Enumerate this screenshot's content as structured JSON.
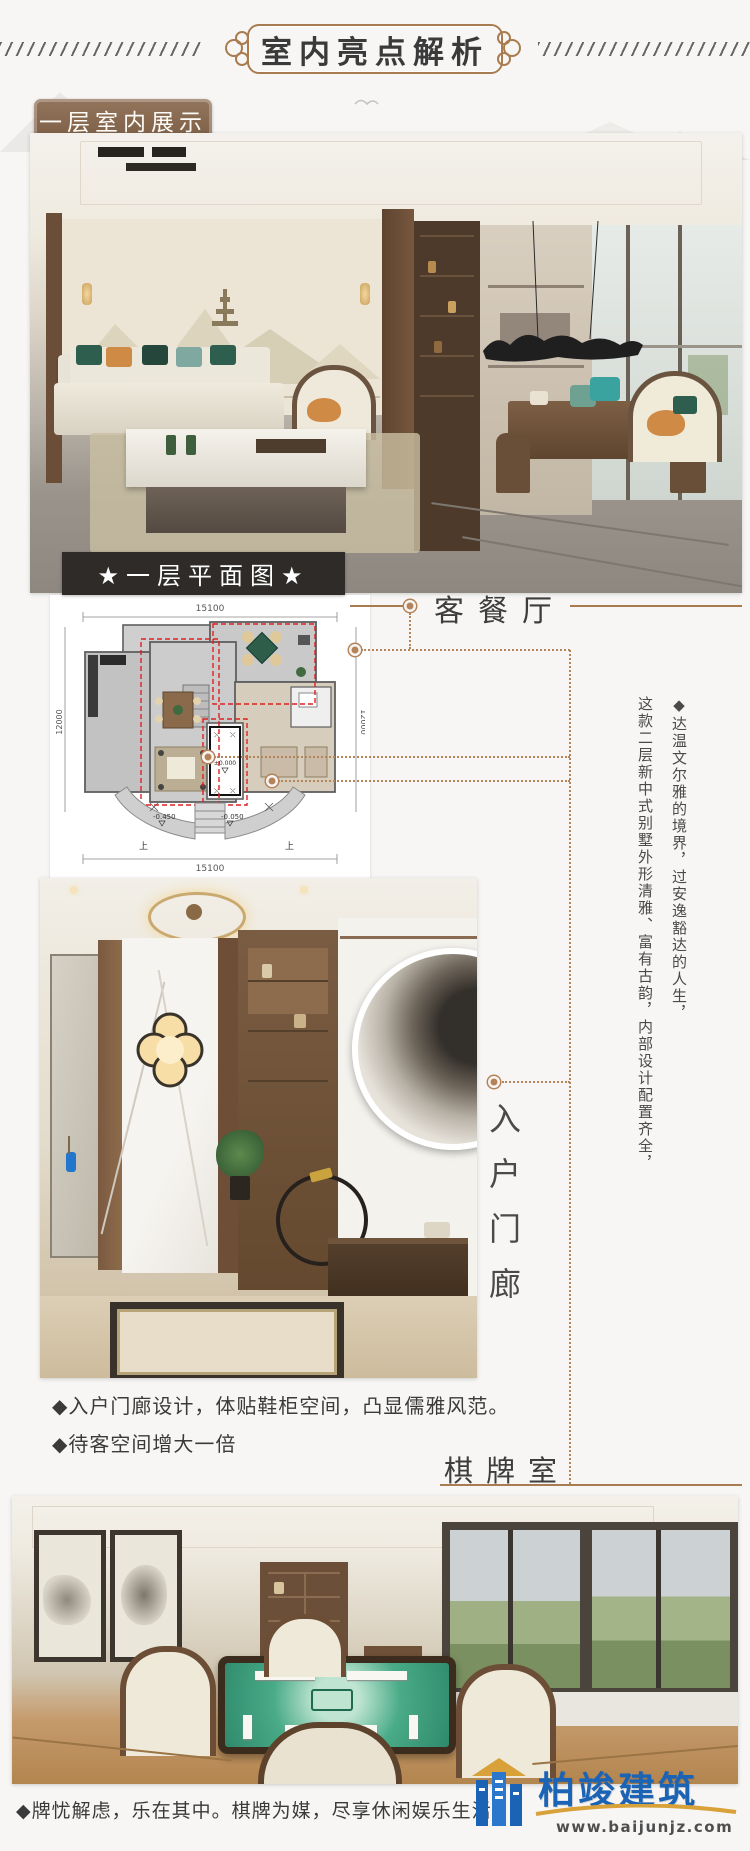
{
  "header": {
    "title": "室内亮点解析"
  },
  "section_label": "一层室内展示",
  "floorplan": {
    "label": "★一层平面图★",
    "dim_top": "15100",
    "dim_bottom": "15100",
    "dim_left": "12000",
    "dim_right": "12000",
    "level_zero": "±0.000",
    "level_minus450": "-0.450",
    "level_minus050": "-0.050",
    "up_left": "上",
    "up_right": "上"
  },
  "room_labels": {
    "living_dining": "客餐厅",
    "entry_hall": "入户门廊",
    "chess_room": "棋牌室"
  },
  "vertical_text": {
    "col1": "◆达温文尔雅的境界，过安逸豁达的人生，",
    "col2": "这款二层新中式别墅外形清雅、富有古韵，内部设计配置齐全，"
  },
  "bullets": {
    "entry_1": "◆入户门廊设计，体贴鞋柜空间，凸显儒雅风范。",
    "entry_2": "◆待客空间增大一倍",
    "chess_1": "◆牌忧解虑，乐在其中。棋牌为媒，尽享休闲娱乐生活。"
  },
  "logo": {
    "name": "柏竣建筑",
    "url": "www.baijunjz.com"
  },
  "colors": {
    "accent_brown": "#a97c50",
    "label_brown": "#8a6a52",
    "dark_bar": "#2e2b28",
    "highlight_red": "#e02020",
    "logo_blue": "#1b63b5",
    "logo_gold": "#d8a13a"
  }
}
